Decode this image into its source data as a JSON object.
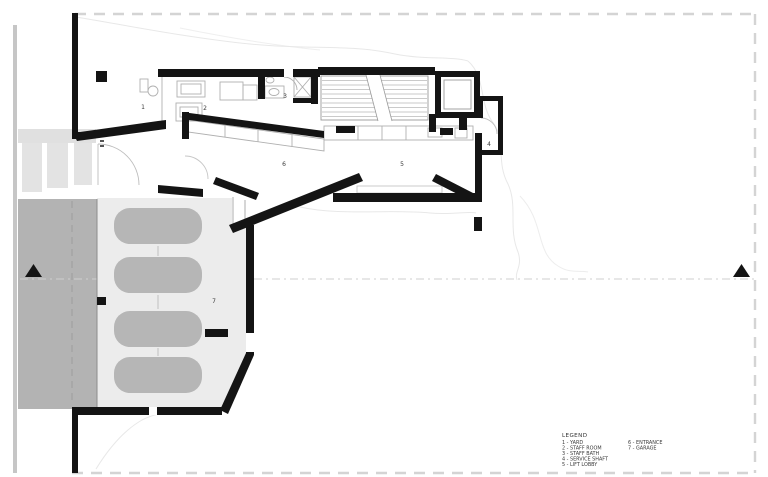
{
  "legend": {
    "title": "LEGEND",
    "col1": [
      "1 - YARD",
      "2 - STAFF ROOM",
      "3 - STAFF BATH",
      "4 - SERVICE SHAFT",
      "5 - LIFT LOBBY"
    ],
    "col2": [
      "6 - ENTRANCE",
      "7 - GARAGE"
    ]
  },
  "rooms": [
    {
      "id": "1",
      "name": "YARD"
    },
    {
      "id": "2",
      "name": "STAFF ROOM"
    },
    {
      "id": "3",
      "name": "STAFF BATH"
    },
    {
      "id": "4",
      "name": "SERVICE SHAFT"
    },
    {
      "id": "5",
      "name": "LIFT LOBBY"
    },
    {
      "id": "6",
      "name": "ENTRANCE"
    },
    {
      "id": "7",
      "name": "GARAGE"
    }
  ],
  "counts": {
    "cars_in_garage": 4
  },
  "colors": {
    "wall": "#141414",
    "driveway": "#b3b3b3",
    "garage_floor": "#ececec",
    "car": "#b6b6b6",
    "site_band": "#c6c6c6",
    "steps": "#e3e3e3",
    "boundary_dash": "#d4d4d4",
    "section_line": "#cfcfcf",
    "contour": "#e8e8e8",
    "thin_line": "#9a9a9a"
  }
}
